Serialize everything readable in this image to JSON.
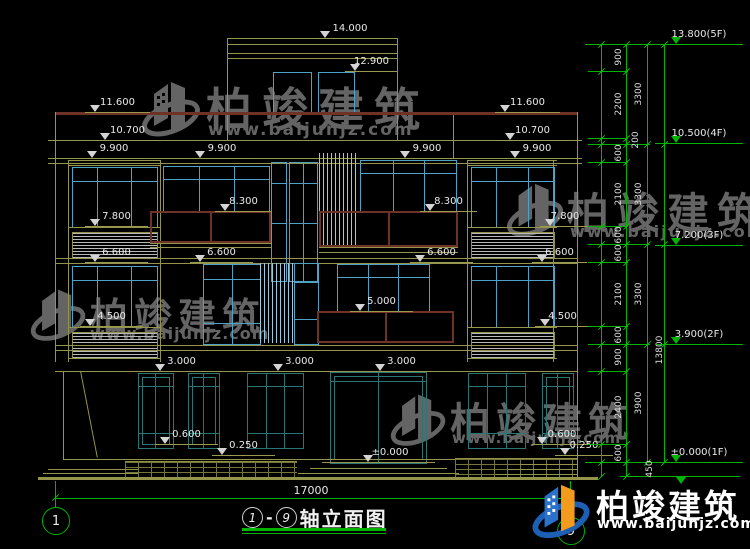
{
  "meta": {
    "sheet_title": "轴立面图",
    "axis_from": "1",
    "axis_to": "9",
    "dash": "-"
  },
  "brand": {
    "name": "柏竣建筑",
    "site": "www.baijunjz.com"
  },
  "dims": {
    "total_width": "17000",
    "right_levels": [
      "13.800(5F)",
      "10.500(4F)",
      "7.200(3F)",
      "3.900(2F)",
      "±0.000(1F)"
    ],
    "inner": [
      "900",
      "2200",
      "200",
      "600",
      "2100",
      "600",
      "600",
      "2100",
      "600",
      "900",
      "2400",
      "600"
    ],
    "floor": [
      "3300",
      "3300",
      "3300",
      "3900"
    ],
    "total_height": "13800",
    "below_grade": "450",
    "facade": [
      "14.000",
      "12.900",
      "11.600",
      "10.700",
      "9.900",
      "9.900",
      "9.900",
      "9.900",
      "11.600",
      "10.700",
      "8.300",
      "8.300",
      "7.800",
      "7.800",
      "6.600",
      "6.600",
      "6.600",
      "6.600",
      "5.000",
      "4.500",
      "4.500",
      "3.000",
      "3.000",
      "3.000",
      "0.600",
      "0.600",
      "0.250",
      "0.250",
      "±0.000"
    ]
  },
  "colors": {
    "background": "#000000",
    "cad_line": "#94944a",
    "window_frame": "#4da2c8",
    "ground_window_frame": "#2a7575",
    "railing": "#6e3226",
    "dimension_green": "#00b400",
    "text_white": "#e8e8e8",
    "watermark_gray": "#7d7d7d",
    "logo_blue": "#2a72cc",
    "logo_orange": "#f29b1d"
  }
}
